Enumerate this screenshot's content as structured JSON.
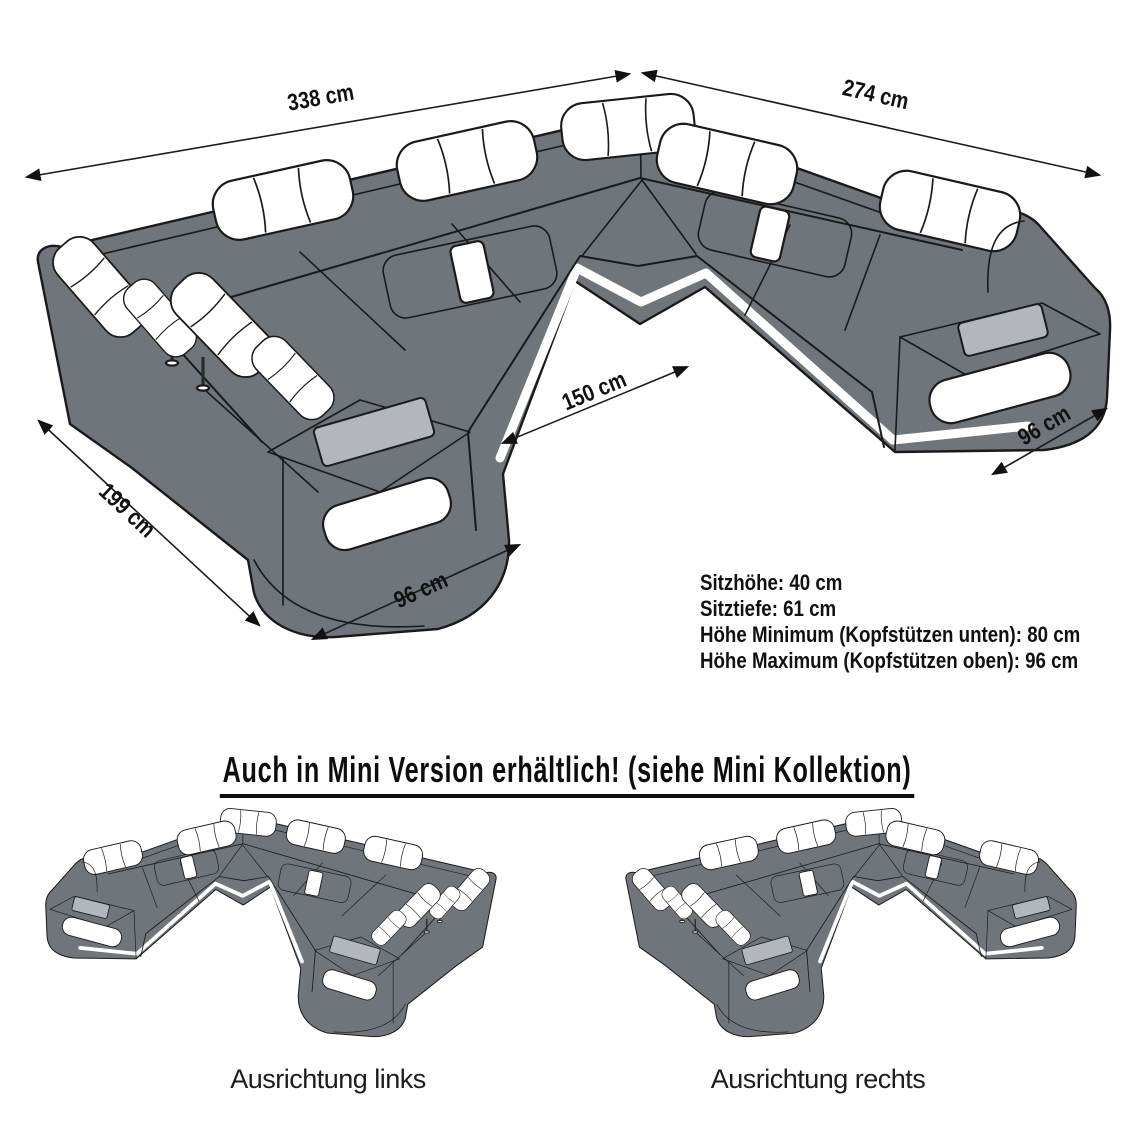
{
  "diagram": {
    "dimensions": {
      "back_width": "338 cm",
      "right_side_depth": "274 cm",
      "inner_opening_width": "150 cm",
      "right_front_width": "96 cm",
      "left_side_depth": "199 cm",
      "left_front_width": "96 cm"
    },
    "specs": [
      "Sitzhöhe: 40 cm",
      "Sitztiefe: 61 cm",
      "Höhe Minimum (Kopfstützen unten): 80 cm",
      "Höhe Maximum (Kopfstützen oben): 96 cm"
    ]
  },
  "mini_section": {
    "heading": "Auch in Mini Version erhältlich! (siehe Mini Kollektion)",
    "variants": [
      {
        "label": "Ausrichtung links"
      },
      {
        "label": "Ausrichtung rechts"
      }
    ]
  },
  "colors": {
    "sofa_body": "#70757c",
    "outline": "#1a1a1a",
    "headrest": "#ffffff",
    "tray": "#b3b7bd",
    "text": "#111111",
    "background": "#ffffff"
  }
}
